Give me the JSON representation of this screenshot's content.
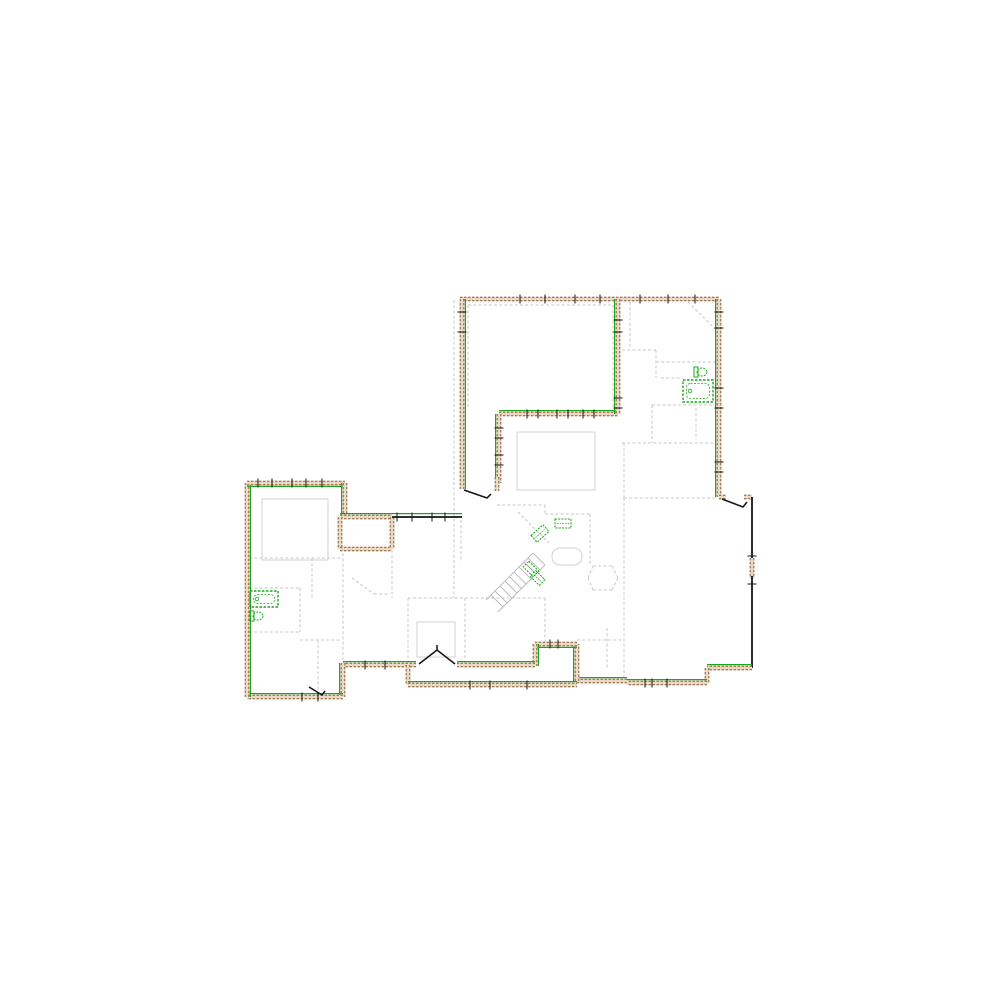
{
  "canvas": {
    "width": 1000,
    "height": 1000,
    "background": "#ffffff"
  },
  "palette": {
    "bg": "#ffffff",
    "wall_fill": "#ead9c4",
    "wall_edge": "#8a5a3a",
    "green": "#1da51d",
    "partition": "#c7c7c7",
    "room_outline": "#d2d2d2",
    "black": "#141414",
    "stair": "#bdbdbd"
  },
  "plan": {
    "walls": [
      {
        "n": "top-wall",
        "x1": 460,
        "y1": 299,
        "x2": 719,
        "y2": 299,
        "k": "ext",
        "g": "none"
      },
      {
        "n": "upper-left-wall",
        "x1": 462,
        "y1": 299,
        "x2": 462,
        "y2": 489,
        "k": "ext",
        "g": "right"
      },
      {
        "n": "upper-right-wall",
        "x1": 719,
        "y1": 299,
        "x2": 719,
        "y2": 497,
        "k": "ext",
        "g": "left"
      },
      {
        "n": "porch-top-wall-a",
        "x1": 719,
        "y1": 497,
        "x2": 726,
        "y2": 497,
        "k": "ext",
        "g": "none"
      },
      {
        "n": "porch-top-wall-b",
        "x1": 744,
        "y1": 497,
        "x2": 752,
        "y2": 497,
        "k": "ext",
        "g": "none"
      },
      {
        "n": "porch-east-wall-upper",
        "x1": 752,
        "y1": 497,
        "x2": 752,
        "y2": 560,
        "k": "blk",
        "g": "none"
      },
      {
        "n": "porch-east-window",
        "x1": 752,
        "y1": 558,
        "x2": 752,
        "y2": 578,
        "k": "ext",
        "g": "none"
      },
      {
        "n": "porch-east-wall-lower",
        "x1": 752,
        "y1": 576,
        "x2": 752,
        "y2": 668,
        "k": "blk",
        "g": "none"
      },
      {
        "n": "porch-bottom-wall",
        "x1": 752,
        "y1": 668,
        "x2": 707,
        "y2": 668,
        "k": "ext",
        "g": "top"
      },
      {
        "n": "south-step-east",
        "x1": 707,
        "y1": 668,
        "x2": 707,
        "y2": 683,
        "k": "ext",
        "g": "none"
      },
      {
        "n": "south-wall-east",
        "x1": 707,
        "y1": 683,
        "x2": 627,
        "y2": 683,
        "k": "ext",
        "g": "top"
      },
      {
        "n": "south-wall-mid",
        "x1": 627,
        "y1": 681,
        "x2": 577,
        "y2": 681,
        "k": "ext",
        "g": "top"
      },
      {
        "n": "stair-notch-east-wall",
        "x1": 577,
        "y1": 681,
        "x2": 577,
        "y2": 644,
        "k": "ext",
        "g": "left"
      },
      {
        "n": "stair-notch-top-wall",
        "x1": 577,
        "y1": 644,
        "x2": 535,
        "y2": 644,
        "k": "ext",
        "g": "bottom"
      },
      {
        "n": "stair-notch-west-wall",
        "x1": 535,
        "y1": 644,
        "x2": 535,
        "y2": 666,
        "k": "ext",
        "g": "right"
      },
      {
        "n": "south-main-wall-east",
        "x1": 535,
        "y1": 665,
        "x2": 457,
        "y2": 665,
        "k": "ext",
        "g": "top"
      },
      {
        "n": "south-main-wall-west",
        "x1": 416,
        "y1": 665,
        "x2": 343,
        "y2": 665,
        "k": "ext",
        "g": "top"
      },
      {
        "n": "porch-step-west",
        "x1": 408,
        "y1": 665,
        "x2": 408,
        "y2": 685,
        "k": "ext",
        "g": "none"
      },
      {
        "n": "lower-porch-south-wall",
        "x1": 408,
        "y1": 685,
        "x2": 577,
        "y2": 685,
        "k": "ext",
        "g": "top"
      },
      {
        "n": "left-wing-east-wall-lower",
        "x1": 343,
        "y1": 663,
        "x2": 343,
        "y2": 697,
        "k": "ext",
        "g": "left"
      },
      {
        "n": "left-wing-south-wall",
        "x1": 343,
        "y1": 697,
        "x2": 247,
        "y2": 697,
        "k": "ext",
        "g": "top"
      },
      {
        "n": "left-wing-west-wall",
        "x1": 247,
        "y1": 697,
        "x2": 247,
        "y2": 483,
        "k": "ext",
        "g": "right"
      },
      {
        "n": "left-wing-north-wall",
        "x1": 247,
        "y1": 483,
        "x2": 345,
        "y2": 483,
        "k": "ext",
        "g": "bottom"
      },
      {
        "n": "left-wing-east-wall-upper",
        "x1": 345,
        "y1": 483,
        "x2": 345,
        "y2": 519,
        "k": "ext",
        "g": "left"
      },
      {
        "n": "closet-north-wall",
        "x1": 340,
        "y1": 517,
        "x2": 392,
        "y2": 517,
        "k": "ext",
        "g": "top"
      },
      {
        "n": "closet-west-wall",
        "x1": 340,
        "y1": 517,
        "x2": 340,
        "y2": 549,
        "k": "ext",
        "g": "none"
      },
      {
        "n": "closet-south-wall",
        "x1": 340,
        "y1": 549,
        "x2": 392,
        "y2": 549,
        "k": "ext",
        "g": "none"
      },
      {
        "n": "closet-east-wall",
        "x1": 392,
        "y1": 517,
        "x2": 392,
        "y2": 549,
        "k": "ext",
        "g": "none"
      },
      {
        "n": "hall-window-band",
        "x1": 392,
        "y1": 517,
        "x2": 462,
        "y2": 517,
        "k": "blk",
        "g": "top"
      },
      {
        "n": "inner-court-north-wall",
        "x1": 499,
        "y1": 414,
        "x2": 618,
        "y2": 414,
        "k": "ext",
        "g": "top"
      },
      {
        "n": "inner-court-west-wall",
        "x1": 499,
        "y1": 414,
        "x2": 499,
        "y2": 483,
        "k": "ext",
        "g": "left"
      },
      {
        "n": "great-room-east-wall",
        "x1": 618,
        "y1": 299,
        "x2": 618,
        "y2": 414,
        "k": "ext",
        "g": "left"
      },
      {
        "n": "door-jamb-wall",
        "x1": 497,
        "y1": 477,
        "x2": 497,
        "y2": 491,
        "k": "ext",
        "g": "none"
      }
    ],
    "window_ticks": [
      {
        "x": 520,
        "y": 299,
        "v": true
      },
      {
        "x": 545,
        "y": 299,
        "v": true
      },
      {
        "x": 575,
        "y": 299,
        "v": true
      },
      {
        "x": 600,
        "y": 299,
        "v": true
      },
      {
        "x": 640,
        "y": 299,
        "v": true
      },
      {
        "x": 668,
        "y": 299,
        "v": true
      },
      {
        "x": 695,
        "y": 299,
        "v": true
      },
      {
        "x": 462,
        "y": 312,
        "v": false
      },
      {
        "x": 462,
        "y": 332,
        "v": false
      },
      {
        "x": 719,
        "y": 312,
        "v": false
      },
      {
        "x": 719,
        "y": 328,
        "v": false
      },
      {
        "x": 719,
        "y": 388,
        "v": false
      },
      {
        "x": 719,
        "y": 408,
        "v": false
      },
      {
        "x": 719,
        "y": 462,
        "v": false
      },
      {
        "x": 719,
        "y": 472,
        "v": false
      },
      {
        "x": 618,
        "y": 320,
        "v": false
      },
      {
        "x": 618,
        "y": 332,
        "v": false
      },
      {
        "x": 618,
        "y": 398,
        "v": false
      },
      {
        "x": 618,
        "y": 408,
        "v": false
      },
      {
        "x": 527,
        "y": 414,
        "v": true
      },
      {
        "x": 538,
        "y": 414,
        "v": true
      },
      {
        "x": 557,
        "y": 414,
        "v": true
      },
      {
        "x": 568,
        "y": 414,
        "v": true
      },
      {
        "x": 583,
        "y": 414,
        "v": true
      },
      {
        "x": 594,
        "y": 414,
        "v": true
      },
      {
        "x": 499,
        "y": 428,
        "v": false
      },
      {
        "x": 499,
        "y": 438,
        "v": false
      },
      {
        "x": 499,
        "y": 455,
        "v": false
      },
      {
        "x": 499,
        "y": 465,
        "v": false
      },
      {
        "x": 397,
        "y": 517,
        "v": true
      },
      {
        "x": 412,
        "y": 517,
        "v": true
      },
      {
        "x": 432,
        "y": 517,
        "v": true
      },
      {
        "x": 445,
        "y": 517,
        "v": true
      },
      {
        "x": 258,
        "y": 483,
        "v": true
      },
      {
        "x": 272,
        "y": 483,
        "v": true
      },
      {
        "x": 292,
        "y": 483,
        "v": true
      },
      {
        "x": 306,
        "y": 483,
        "v": true
      },
      {
        "x": 322,
        "y": 483,
        "v": true
      },
      {
        "x": 365,
        "y": 665,
        "v": true
      },
      {
        "x": 385,
        "y": 665,
        "v": true
      },
      {
        "x": 470,
        "y": 685,
        "v": true
      },
      {
        "x": 490,
        "y": 685,
        "v": true
      },
      {
        "x": 527,
        "y": 685,
        "v": true
      },
      {
        "x": 645,
        "y": 683,
        "v": true
      },
      {
        "x": 652,
        "y": 683,
        "v": true
      },
      {
        "x": 667,
        "y": 683,
        "v": true
      },
      {
        "x": 550,
        "y": 644,
        "v": true
      },
      {
        "x": 558,
        "y": 644,
        "v": true
      },
      {
        "x": 752,
        "y": 556,
        "v": false
      },
      {
        "x": 752,
        "y": 584,
        "v": false
      },
      {
        "x": 302,
        "y": 697,
        "v": true
      },
      {
        "x": 318,
        "y": 697,
        "v": true
      }
    ],
    "partitions": [
      [
        468,
        305,
        613,
        305
      ],
      [
        468,
        305,
        468,
        408
      ],
      [
        613,
        305,
        613,
        408
      ],
      [
        454,
        300,
        454,
        598
      ],
      [
        688,
        302,
        716,
        330
      ],
      [
        630,
        302,
        630,
        347
      ],
      [
        622,
        350,
        656,
        350
      ],
      [
        656,
        350,
        656,
        378
      ],
      [
        656,
        362,
        717,
        362
      ],
      [
        652,
        405,
        717,
        405
      ],
      [
        652,
        405,
        652,
        443
      ],
      [
        622,
        443,
        717,
        443
      ],
      [
        624,
        443,
        624,
        498
      ],
      [
        624,
        498,
        717,
        498
      ],
      [
        624,
        498,
        624,
        681
      ],
      [
        696,
        408,
        696,
        440
      ],
      [
        661,
        378,
        683,
        378
      ],
      [
        497,
        505,
        545,
        505
      ],
      [
        545,
        505,
        545,
        514
      ],
      [
        545,
        514,
        590,
        514
      ],
      [
        590,
        514,
        590,
        566
      ],
      [
        518,
        512,
        549,
        543
      ],
      [
        545,
        598,
        545,
        643
      ],
      [
        408,
        598,
        545,
        598
      ],
      [
        408,
        598,
        408,
        663
      ],
      [
        465,
        598,
        465,
        663
      ],
      [
        577,
        640,
        624,
        640
      ],
      [
        461,
        520,
        461,
        562
      ],
      [
        392,
        550,
        392,
        598
      ],
      [
        352,
        578,
        374,
        594
      ],
      [
        374,
        594,
        390,
        594
      ],
      [
        249,
        558,
        341,
        558
      ],
      [
        312,
        558,
        312,
        600
      ],
      [
        249,
        588,
        300,
        588
      ],
      [
        300,
        588,
        300,
        632
      ],
      [
        249,
        632,
        300,
        632
      ],
      [
        300,
        640,
        341,
        640
      ],
      [
        318,
        640,
        318,
        695
      ],
      [
        343,
        548,
        343,
        663
      ],
      [
        593,
        566,
        612,
        566
      ],
      [
        612,
        566,
        618,
        578
      ],
      [
        618,
        578,
        612,
        590
      ],
      [
        612,
        590,
        593,
        590
      ],
      [
        593,
        590,
        588,
        578
      ],
      [
        588,
        578,
        593,
        566
      ],
      [
        607,
        628,
        607,
        668
      ]
    ],
    "room_outlines": [
      {
        "n": "open-below-outline",
        "x": 517,
        "y": 432,
        "w": 78,
        "h": 58,
        "rx": 0
      },
      {
        "n": "left-room-outline",
        "x": 262,
        "y": 499,
        "w": 66,
        "h": 61,
        "rx": 0
      },
      {
        "n": "lower-room-outline",
        "x": 417,
        "y": 622,
        "w": 38,
        "h": 35,
        "rx": 0
      },
      {
        "n": "island-outline",
        "x": 552,
        "y": 548,
        "w": 30,
        "h": 17,
        "rx": 8
      }
    ],
    "stairs": {
      "lines": [
        [
          533,
          553,
          486,
          600
        ],
        [
          545,
          565,
          498,
          612
        ],
        [
          533,
          553,
          545,
          565
        ],
        [
          528,
          558,
          540,
          570
        ],
        [
          524,
          562,
          536,
          574
        ],
        [
          519,
          567,
          531,
          579
        ],
        [
          514,
          572,
          526,
          584
        ],
        [
          510,
          577,
          522,
          589
        ],
        [
          505,
          581,
          517,
          593
        ],
        [
          500,
          586,
          512,
          598
        ],
        [
          495,
          591,
          507,
          603
        ],
        [
          491,
          595,
          503,
          607
        ]
      ]
    },
    "doors": [
      {
        "n": "upper-room-door",
        "pts": "464,490 487,498 491,494"
      },
      {
        "n": "porch-door",
        "pts": "722,499 743,507 747,502"
      },
      {
        "n": "french-door-left-leaf",
        "pts": "419,664 437,650"
      },
      {
        "n": "french-door-right-leaf",
        "pts": "455,664 437,650"
      },
      {
        "n": "french-door-apex",
        "pts": "437,650 437,645"
      },
      {
        "n": "left-wing-door",
        "pts": "309,687 322,695 325,691"
      }
    ],
    "fixtures": [
      {
        "t": "tub",
        "n": "bathtub-upper",
        "x": 683,
        "y": 380,
        "w": 30,
        "h": 22
      },
      {
        "t": "toilet",
        "n": "toilet-upper",
        "cx": 702,
        "cy": 372,
        "rx": 5,
        "ry": 4,
        "tx": 694,
        "ty": 367,
        "tw": 4,
        "th": 10
      },
      {
        "t": "tub",
        "n": "bathtub-left",
        "x": 250,
        "y": 591,
        "w": 28,
        "h": 16
      },
      {
        "t": "toilet",
        "n": "toilet-left",
        "cx": 258,
        "cy": 616,
        "rx": 5,
        "ry": 4,
        "tx": 250,
        "ty": 611,
        "tw": 4,
        "th": 10
      },
      {
        "t": "appliance",
        "n": "appliance-counter",
        "x": 555,
        "y": 519,
        "w": 16,
        "h": 9,
        "rot": 0
      },
      {
        "t": "appliance",
        "n": "appliance-diagonal",
        "x": 532,
        "y": 529,
        "w": 16,
        "h": 9,
        "rot": -42
      },
      {
        "t": "appliance",
        "n": "laundry-unit-a",
        "x": 524,
        "y": 565,
        "w": 14,
        "h": 8,
        "rot": 45
      },
      {
        "t": "appliance",
        "n": "laundry-unit-b",
        "x": 531,
        "y": 574,
        "w": 13,
        "h": 8,
        "rot": 45
      }
    ]
  }
}
